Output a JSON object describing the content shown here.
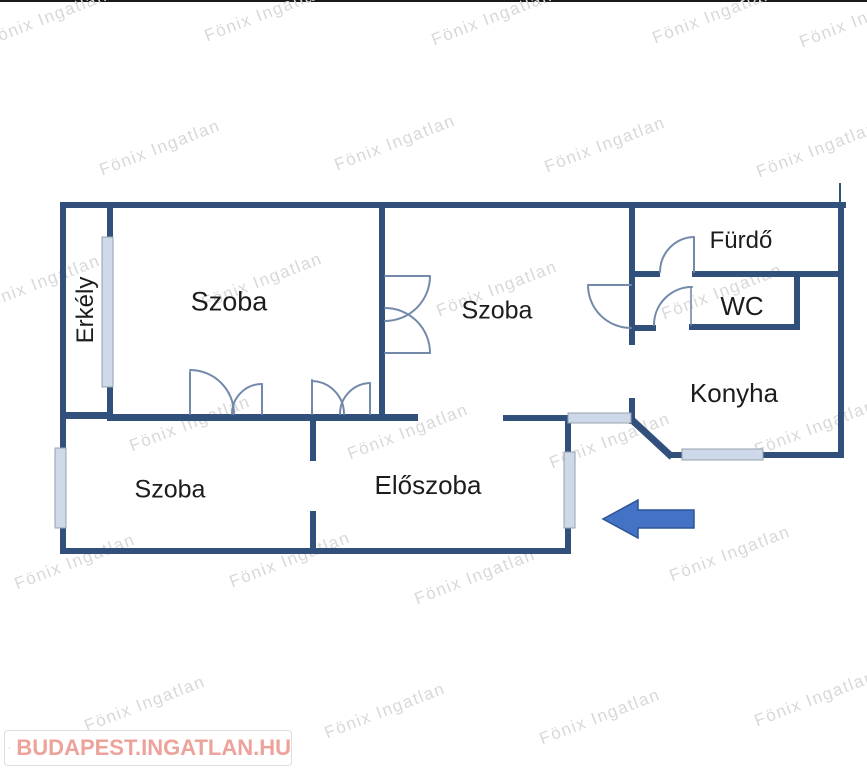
{
  "meta": {
    "canvas_width": 867,
    "canvas_height": 768,
    "type": "apartment-floor-plan"
  },
  "watermark": {
    "text": "Fönix Ingatlan",
    "color": "#d8d8d8",
    "angle_deg": -21,
    "positions": [
      [
        47,
        18
      ],
      [
        265,
        14
      ],
      [
        492,
        18
      ],
      [
        713,
        16
      ],
      [
        860,
        20
      ],
      [
        160,
        148
      ],
      [
        395,
        143
      ],
      [
        605,
        145
      ],
      [
        817,
        150
      ],
      [
        40,
        283
      ],
      [
        262,
        281
      ],
      [
        497,
        289
      ],
      [
        722,
        292
      ],
      [
        190,
        424
      ],
      [
        408,
        432
      ],
      [
        610,
        441
      ],
      [
        815,
        428
      ],
      [
        75,
        562
      ],
      [
        290,
        560
      ],
      [
        475,
        577
      ],
      [
        730,
        554
      ],
      [
        145,
        704
      ],
      [
        385,
        711
      ],
      [
        600,
        717
      ],
      [
        815,
        699
      ]
    ]
  },
  "floorplan": {
    "wall_color": "#31517c",
    "door_color": "#7389aa",
    "window_fill": "#cdd9e9",
    "window_border": "#97a1ae",
    "arrow_color": "#4472c4",
    "arrow_border": "#2f5597",
    "rooms": [
      {
        "id": "erkely",
        "label": "Erkély"
      },
      {
        "id": "szoba-upper-left",
        "label": "Szoba"
      },
      {
        "id": "szoba-middle",
        "label": "Szoba"
      },
      {
        "id": "furdo",
        "label": "Fürdő"
      },
      {
        "id": "wc",
        "label": "WC"
      },
      {
        "id": "konyha",
        "label": "Konyha"
      },
      {
        "id": "szoba-lower-left",
        "label": "Szoba"
      },
      {
        "id": "eloszoba",
        "label": "Előszoba"
      }
    ]
  },
  "branding": {
    "logo_text": "BUDAPEST.INGATLAN.HU",
    "text_color": "#eda29b",
    "icon_color": "#e4857e"
  }
}
